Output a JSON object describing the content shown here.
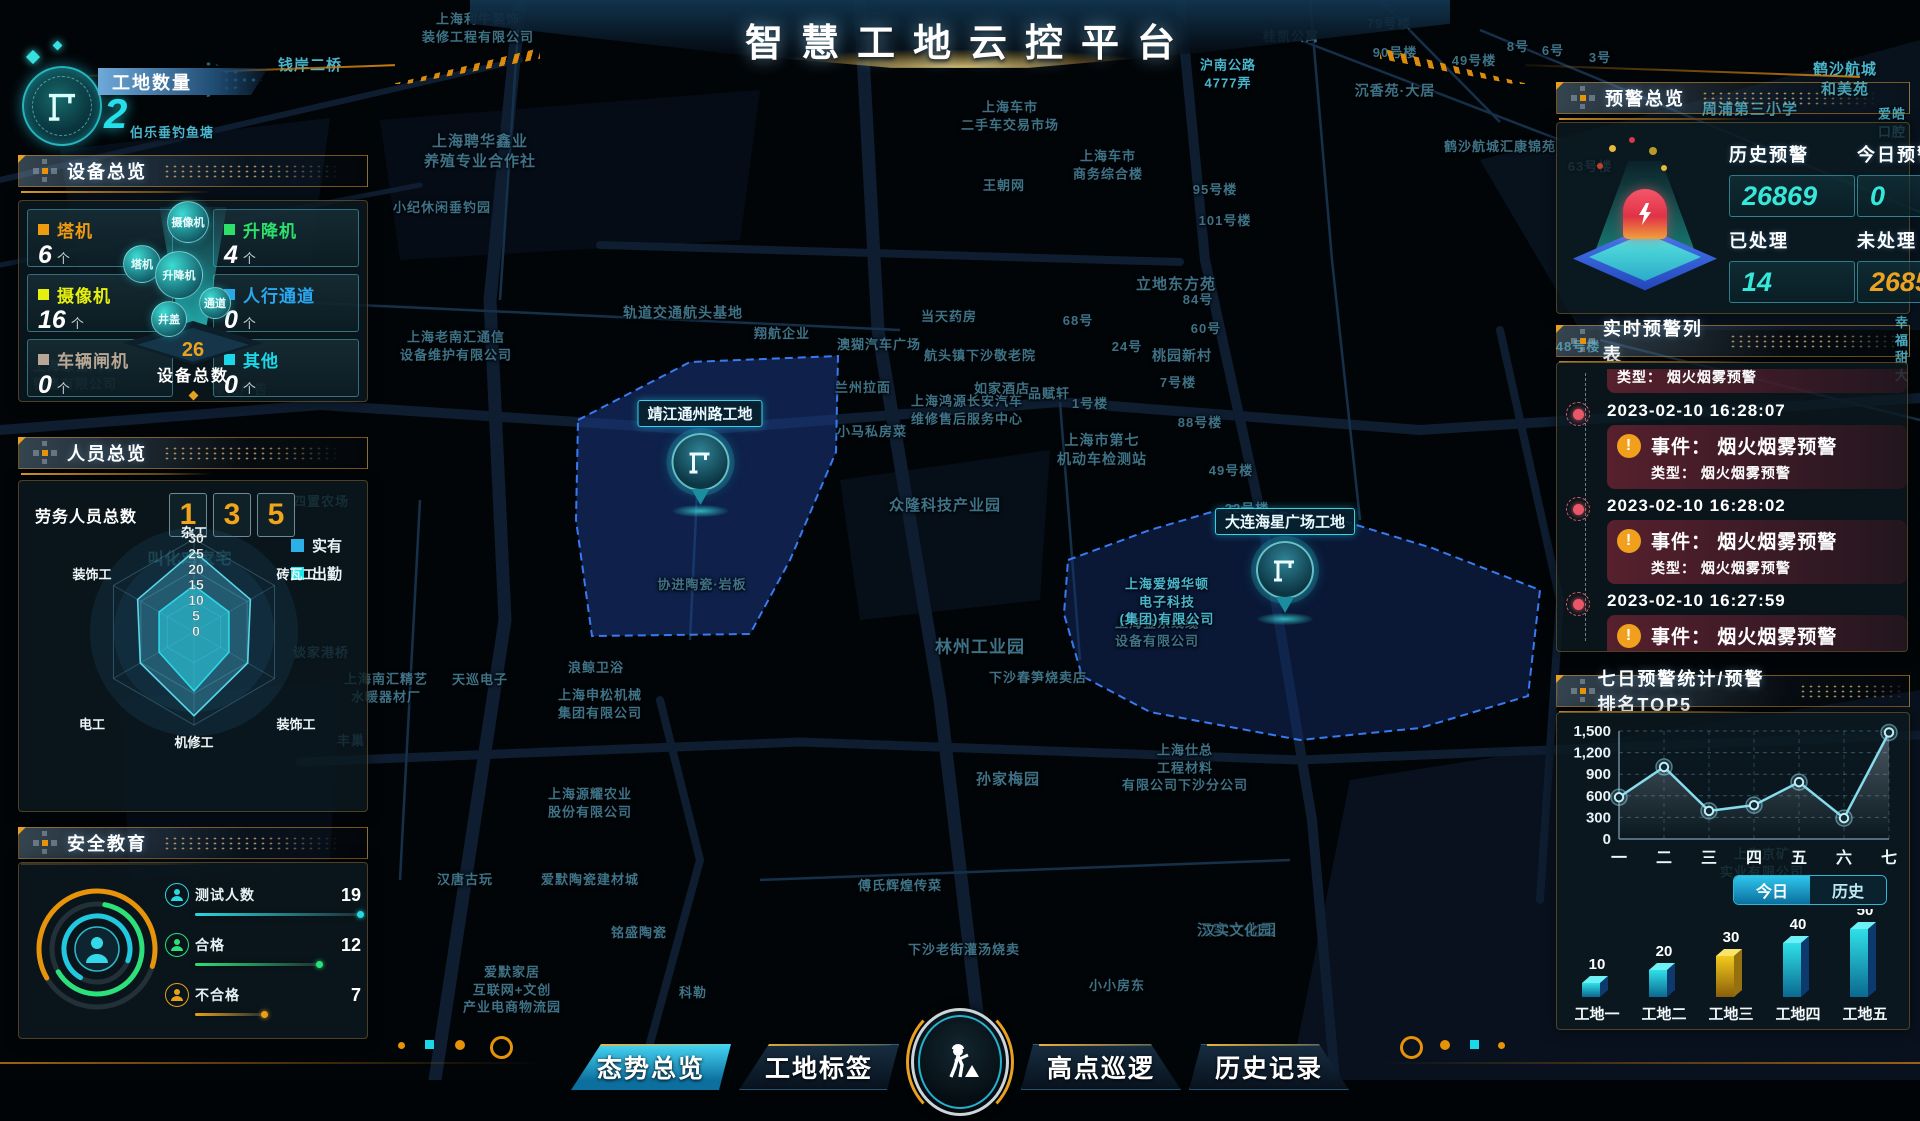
{
  "title": "智慧工地云控平台",
  "site_count": {
    "label": "工地数量",
    "value": "2"
  },
  "accent": {
    "orange": "#e8920a",
    "cyan": "#25e0e8",
    "alarm_red": "#e85868"
  },
  "map": {
    "site_markers": [
      {
        "label": "靖江通州路工地"
      },
      {
        "label": "大连海星广场工地"
      }
    ],
    "labels": [
      {
        "t": "上海利牛装饰\n装修工程有限公司",
        "x": 478,
        "y": 28
      },
      {
        "t": "钱岸二桥",
        "x": 310,
        "y": 66,
        "b": 1,
        "s": 15
      },
      {
        "t": "伯乐垂钓鱼塘",
        "x": 172,
        "y": 133,
        "b": 1
      },
      {
        "t": "上海聘华鑫业\n养殖专业合作社",
        "x": 480,
        "y": 152,
        "s": 15
      },
      {
        "t": "小纪休闲垂钓园",
        "x": 442,
        "y": 208
      },
      {
        "t": "轨道交通航头基地",
        "x": 683,
        "y": 313,
        "s": 14
      },
      {
        "t": "上海老南汇通信\n设备维护有限公司",
        "x": 456,
        "y": 346
      },
      {
        "t": "翔航企业",
        "x": 782,
        "y": 334
      },
      {
        "t": "品赋轩",
        "x": 1049,
        "y": 394
      },
      {
        "t": "兰州拉面",
        "x": 863,
        "y": 388
      },
      {
        "t": "小马私房菜",
        "x": 872,
        "y": 432
      },
      {
        "t": "上海鸿源长安汽车\n维修售后服务中心",
        "x": 967,
        "y": 410
      },
      {
        "t": "上海市第七\n机动车检测站",
        "x": 1102,
        "y": 450,
        "s": 14
      },
      {
        "t": "众隆科技产业园",
        "x": 945,
        "y": 506,
        "s": 15
      },
      {
        "t": "协进陶瓷·岩板",
        "x": 702,
        "y": 585
      },
      {
        "t": "四置农场",
        "x": 321,
        "y": 502
      },
      {
        "t": "谈家港桥",
        "x": 321,
        "y": 653
      },
      {
        "t": "上海南汇精艺\n水暖器材厂",
        "x": 386,
        "y": 688
      },
      {
        "t": "天巡电子",
        "x": 480,
        "y": 680
      },
      {
        "t": "浪鲸卫浴",
        "x": 596,
        "y": 668
      },
      {
        "t": "上海申松机械\n集团有限公司",
        "x": 600,
        "y": 704
      },
      {
        "t": "丰巢",
        "x": 351,
        "y": 741
      },
      {
        "t": "上海源耀农业\n股份有限公司",
        "x": 590,
        "y": 803
      },
      {
        "t": "汉唐古玩",
        "x": 465,
        "y": 880
      },
      {
        "t": "爱默陶瓷建材城",
        "x": 590,
        "y": 880
      },
      {
        "t": "铭盛陶瓷",
        "x": 639,
        "y": 933
      },
      {
        "t": "科勒",
        "x": 693,
        "y": 993
      },
      {
        "t": "爱默家居\n互联网+文创\n产业电商物流园",
        "x": 512,
        "y": 990
      },
      {
        "t": "傅氏辉煌传菜",
        "x": 900,
        "y": 886
      },
      {
        "t": "下沙老街灌汤烧卖",
        "x": 964,
        "y": 950
      },
      {
        "t": "小小房东",
        "x": 1117,
        "y": 986
      },
      {
        "t": "孙家梅园",
        "x": 1008,
        "y": 780,
        "s": 15
      },
      {
        "t": "林州工业园",
        "x": 980,
        "y": 648,
        "s": 17
      },
      {
        "t": "下沙春笋烧卖店",
        "x": 1038,
        "y": 678
      },
      {
        "t": "上海金东线缆\n设备有限公司",
        "x": 1157,
        "y": 632
      },
      {
        "t": "上海仕总\n工程材料\n有限公司下沙分公司",
        "x": 1185,
        "y": 768
      },
      {
        "t": "汉实文化园",
        "x": 1237,
        "y": 931,
        "s": 15
      },
      {
        "t": "上海爱姆华顿\n电子科技\n(集团)有限公司",
        "x": 1167,
        "y": 602,
        "b": 1
      },
      {
        "t": "当天药房",
        "x": 949,
        "y": 317
      },
      {
        "t": "澳猢汽车广场",
        "x": 879,
        "y": 345
      },
      {
        "t": "航头镇下沙敬老院",
        "x": 980,
        "y": 356
      },
      {
        "t": "如家酒店",
        "x": 1002,
        "y": 389
      },
      {
        "t": "1号楼",
        "x": 1090,
        "y": 404
      },
      {
        "t": "88号楼",
        "x": 1200,
        "y": 423
      },
      {
        "t": "49号楼",
        "x": 1231,
        "y": 471
      },
      {
        "t": "22号楼",
        "x": 1247,
        "y": 509
      },
      {
        "t": "7号楼",
        "x": 1178,
        "y": 383
      },
      {
        "t": "桃园新村",
        "x": 1182,
        "y": 356,
        "s": 14
      },
      {
        "t": "24号",
        "x": 1127,
        "y": 347
      },
      {
        "t": "60号",
        "x": 1206,
        "y": 329
      },
      {
        "t": "68号",
        "x": 1078,
        "y": 321
      },
      {
        "t": "84号",
        "x": 1198,
        "y": 300
      },
      {
        "t": "立地东方苑",
        "x": 1176,
        "y": 285,
        "s": 15
      },
      {
        "t": "95号楼",
        "x": 1215,
        "y": 190
      },
      {
        "t": "101号楼",
        "x": 1225,
        "y": 221
      },
      {
        "t": "王朝网",
        "x": 1004,
        "y": 186
      },
      {
        "t": "上海车市\n商务综合楼",
        "x": 1108,
        "y": 165
      },
      {
        "t": "上海车市\n二手车交易市场",
        "x": 1010,
        "y": 116
      },
      {
        "t": "沪南公路\n4777弄",
        "x": 1228,
        "y": 74,
        "b": 1
      },
      {
        "t": "桂凯公寓",
        "x": 1291,
        "y": 37
      },
      {
        "t": "79号楼",
        "x": 1389,
        "y": 24
      },
      {
        "t": "90号楼",
        "x": 1395,
        "y": 53
      },
      {
        "t": "49号楼",
        "x": 1474,
        "y": 61
      },
      {
        "t": "沉香苑·大居",
        "x": 1395,
        "y": 91,
        "s": 14
      },
      {
        "t": "8号",
        "x": 1518,
        "y": 47
      },
      {
        "t": "6号",
        "x": 1553,
        "y": 51
      },
      {
        "t": "3号",
        "x": 1600,
        "y": 58
      },
      {
        "t": "鹤沙航城汇康锦苑",
        "x": 1500,
        "y": 147
      },
      {
        "t": "周浦第三小学",
        "x": 1750,
        "y": 110,
        "b": 1,
        "s": 15
      },
      {
        "t": "鹤沙航城和美苑",
        "x": 1845,
        "y": 80,
        "b": 1,
        "s": 15
      },
      {
        "t": "爱皓口腔",
        "x": 1892,
        "y": 123,
        "b": 1
      },
      {
        "t": "63号楼",
        "x": 1590,
        "y": 167
      },
      {
        "t": "48号楼",
        "x": 1578,
        "y": 347,
        "b": 1
      },
      {
        "t": "幸福甜大",
        "x": 1902,
        "y": 349,
        "b": 1
      },
      {
        "t": "上海京矿\n实业有限公司",
        "x": 1762,
        "y": 863
      },
      {
        "t": "豫见广告",
        "x": 240,
        "y": 390
      },
      {
        "t": "上海恩锡汽车\n销售有限公司",
        "x": 75,
        "y": 375
      },
      {
        "t": "叫化鸡家宅",
        "x": 190,
        "y": 560,
        "b": 1,
        "s": 16
      },
      {
        "t": "汉实文化园",
        "x": 1237,
        "y": 931
      }
    ]
  },
  "panels": {
    "device": {
      "title": "设备总览",
      "total_label": "设备总数",
      "total": "26",
      "cards": [
        {
          "name": "塔机",
          "count": "6",
          "unit": "个",
          "color": "#ef9b10"
        },
        {
          "name": "升降机",
          "count": "4",
          "unit": "个",
          "color": "#2ce06a"
        },
        {
          "name": "摄像机",
          "count": "16",
          "unit": "个",
          "color": "#e7f00c"
        },
        {
          "name": "人行通道",
          "count": "0",
          "unit": "个",
          "color": "#2aa8f0"
        },
        {
          "name": "车辆闸机",
          "count": "0",
          "unit": "个",
          "color": "#b9a795"
        },
        {
          "name": "其他",
          "count": "0",
          "unit": "个",
          "color": "#1ad8e8"
        }
      ],
      "funnel_bubbles": [
        "摄像机",
        "塔机",
        "升降机",
        "通道",
        "井盖"
      ]
    },
    "personnel": {
      "title": "人员总览",
      "total_label": "劳务人员总数",
      "digits": [
        "1",
        "3",
        "5"
      ],
      "legend": [
        {
          "label": "实有",
          "color": "#2bb0e8"
        },
        {
          "label": "出勤",
          "color": "#19e8e8"
        }
      ]
    },
    "safety": {
      "title": "安全教育",
      "rows": [
        {
          "label": "测试人数",
          "value": "19",
          "color": "#2ad8e0",
          "pct": 1.0
        },
        {
          "label": "合格",
          "value": "12",
          "color": "#2ce07a",
          "pct": 0.75
        },
        {
          "label": "不合格",
          "value": "7",
          "color": "#e8a01a",
          "pct": 0.42
        }
      ]
    },
    "alarm_overview": {
      "title": "预警总览",
      "stats": [
        {
          "label": "历史预警",
          "value": "26869",
          "color": "#36e8da"
        },
        {
          "label": "今日预警",
          "value": "0",
          "color": "#36e8da"
        },
        {
          "label": "已处理",
          "value": "14",
          "color": "#36e8da"
        },
        {
          "label": "未处理",
          "value": "26855",
          "color": "#eda221"
        }
      ]
    },
    "alarm_list": {
      "title": "实时预警列表",
      "partial_top_type": "类型： 烟火烟雾预警",
      "entries": [
        {
          "time": "2023-02-10 16:28:07",
          "event": "事件： 烟火烟雾预警",
          "type": "类型： 烟火烟雾预警"
        },
        {
          "time": "2023-02-10 16:28:02",
          "event": "事件： 烟火烟雾预警",
          "type": "类型： 烟火烟雾预警"
        },
        {
          "time": "2023-02-10 16:27:59",
          "event": "事件： 烟火烟雾预警",
          "type": "类型： 烟火烟雾预警"
        }
      ]
    },
    "weekly": {
      "title": "七日预警统计/预警排名TOP5",
      "toggle": [
        {
          "label": "今日",
          "active": true
        },
        {
          "label": "历史",
          "active": false
        }
      ]
    }
  },
  "chart_data": [
    {
      "type": "line",
      "title": "七日预警统计",
      "x": [
        "一",
        "二",
        "三",
        "四",
        "五",
        "六",
        "七"
      ],
      "values": [
        580,
        1000,
        390,
        470,
        790,
        290,
        1480
      ],
      "ylim": [
        0,
        1500
      ],
      "yticks": [
        "0",
        "300",
        "600",
        "900",
        "1,200",
        "1,500"
      ],
      "grid": "dashed"
    },
    {
      "type": "bar",
      "title": "预警排名TOP5",
      "categories": [
        "工地一",
        "工地二",
        "工地三",
        "工地四",
        "工地五"
      ],
      "values": [
        10,
        20,
        30,
        40,
        50
      ],
      "highlight_index": 2,
      "bar_color": "teal-3d",
      "highlight_color": "yellow-3d"
    },
    {
      "type": "radar",
      "title": "劳务人员总数",
      "axes": [
        "杂工",
        "砖瓦工",
        "装饰工",
        "机修工",
        "电工",
        "装饰工"
      ],
      "max": 30,
      "ticks": [
        30,
        25,
        20,
        15,
        10,
        5,
        0
      ],
      "series": [
        {
          "name": "实有",
          "values": [
            26,
            21,
            20,
            27,
            20,
            21
          ]
        },
        {
          "name": "出勤",
          "values": [
            15,
            13,
            13,
            19,
            13,
            13
          ]
        }
      ]
    }
  ],
  "tabs": [
    {
      "label": "态势总览",
      "active": true
    },
    {
      "label": "工地标签",
      "active": false
    },
    {
      "label": "高点巡逻",
      "active": false
    },
    {
      "label": "历史记录",
      "active": false
    }
  ]
}
